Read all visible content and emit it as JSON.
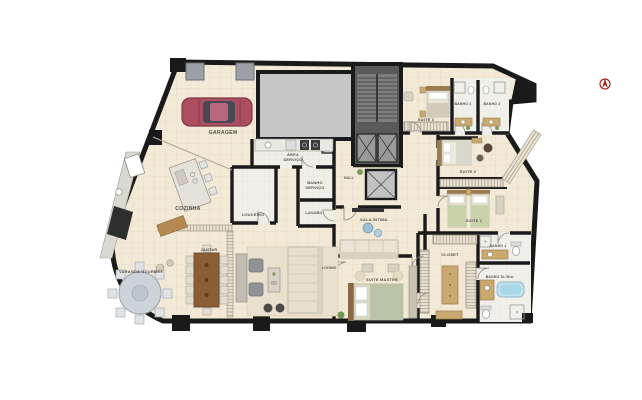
{
  "title": "Apartment floor plan",
  "canvas": {
    "width": 642,
    "height": 400,
    "background": "#ffffff"
  },
  "palette": {
    "floor": "#f2e9d6",
    "floor_grid": "#e5d9c1",
    "wet_floor": "#f1f0ea",
    "wall": "#1a1a1a",
    "core": "#5a5a5a",
    "shaft": "#c6c6c6",
    "wood": "#8a5f36",
    "cabinet": "#c9a96e",
    "upholstery": "#e6e1d3",
    "bed_green": "#c8d2a8",
    "tub_blue": "#bfe3ef",
    "car_red": "#a64a5a",
    "compass_red": "#a82a1e",
    "label": "#55504a"
  },
  "plan": {
    "type": "residential-apartment-floor-plan",
    "rooms": [
      {
        "id": "garagem",
        "label": "GARAGEM"
      },
      {
        "id": "area-servico",
        "label": "ÁREA SERVIÇO",
        "lines": [
          "ÁREA",
          "SERVIÇO"
        ]
      },
      {
        "id": "cozinha",
        "label": "COZINHA"
      },
      {
        "id": "louceiro",
        "label": "LOUCEIRO"
      },
      {
        "id": "banho-servico",
        "label": "BANHO SERVIÇO",
        "lines": [
          "BANHO",
          "SERVIÇO"
        ]
      },
      {
        "id": "lavabo",
        "label": "LAVABO"
      },
      {
        "id": "hall",
        "label": "HALL"
      },
      {
        "id": "sala-intima",
        "label": "SALA ÍNTIMA"
      },
      {
        "id": "suite-3",
        "label": "SUITE 3"
      },
      {
        "id": "banho-3",
        "label": "BANHO 3"
      },
      {
        "id": "banho-2",
        "label": "BANHO 2"
      },
      {
        "id": "suite-2",
        "label": "SUITE 2"
      },
      {
        "id": "suite-1",
        "label": "SUITE 1"
      },
      {
        "id": "banho-1",
        "label": "BANHO 1"
      },
      {
        "id": "closet",
        "label": "CLOSET"
      },
      {
        "id": "banho-sr-sra",
        "label": "BANHO Sr./Sra."
      },
      {
        "id": "suite-master",
        "label": "SUITE MASTER"
      },
      {
        "id": "living",
        "label": "LIVING"
      },
      {
        "id": "jantar",
        "label": "JANTAR"
      },
      {
        "id": "varanda-gourmet",
        "label": "VARANDA GOURMET"
      }
    ],
    "common_areas": [
      "stairs",
      "elevators",
      "elevator-lobby"
    ],
    "furniture_icons": [
      "car",
      "dining-table-12-seats",
      "round-table-8-seats",
      "kitchen-island",
      "sectional-sofa",
      "sofa",
      "double-bed",
      "single-bed",
      "king-bed",
      "bathtub",
      "shower",
      "toilet",
      "vanity",
      "washer",
      "closet-island",
      "stairs",
      "elevator",
      "wardrobe",
      "tv-console",
      "armchair",
      "pouf",
      "plant"
    ],
    "compass": {
      "present": true,
      "color": "#a82a1e"
    }
  }
}
